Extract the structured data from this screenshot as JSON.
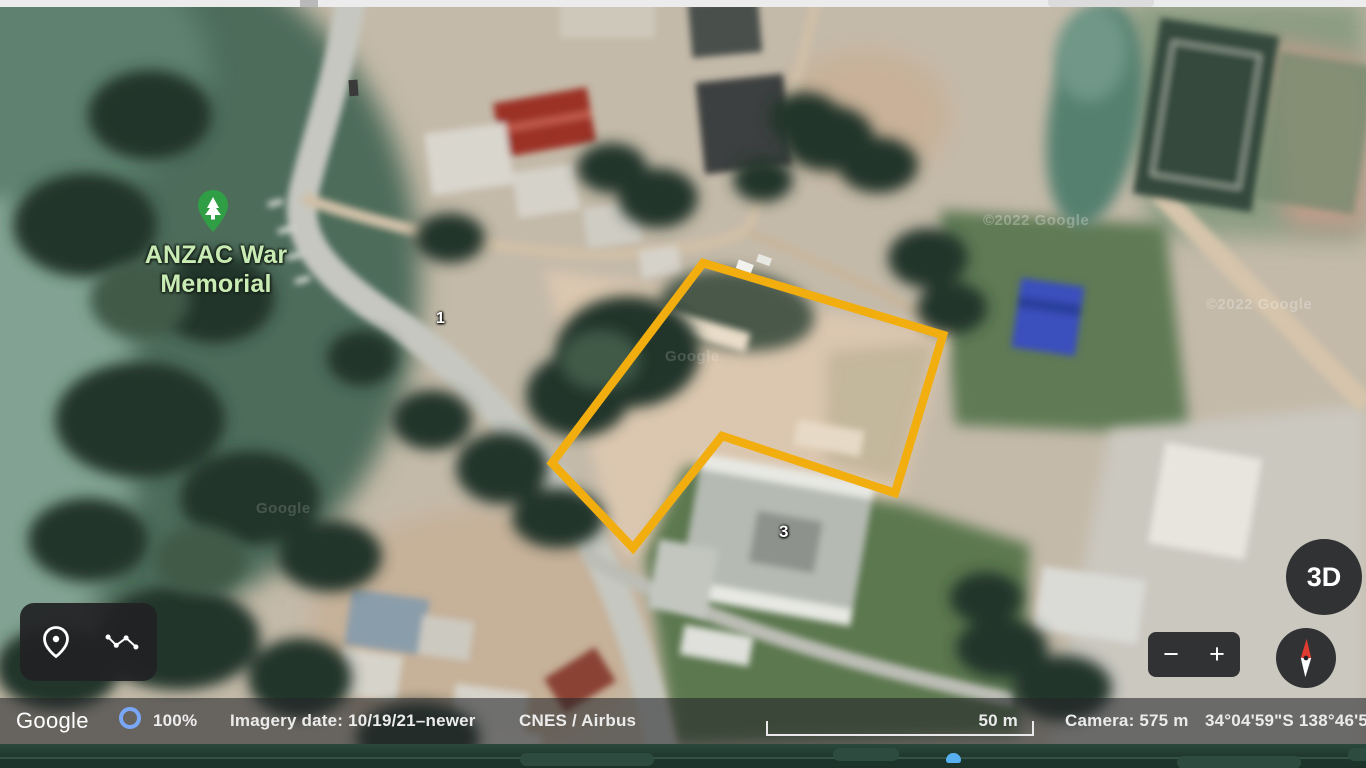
{
  "map": {
    "place_label": "ANZAC War Memorial",
    "marker_1": "1",
    "marker_3": "3",
    "watermark_a": "©2022 Google",
    "watermark_b": "©2022 Google",
    "watermark_c": "Google",
    "watermark_d": "Google"
  },
  "controls": {
    "three_d": "3D",
    "zoom_out": "−",
    "zoom_in": "+"
  },
  "status_bar": {
    "brand": "Google",
    "progress_percent": "100%",
    "imagery_date": "Imagery date: 10/19/21–newer",
    "provider": "CNES / Airbus",
    "scale_label": "50 m",
    "camera_altitude": "Camera: 575 m",
    "coordinates": "34°04'59\"S 138°46'5"
  },
  "colors": {
    "parcel_outline": "#F2AE0F",
    "placemark_green": "#2f9e44",
    "progress_ring_blue": "#7AA7F8",
    "compass_needle_red": "#E03B2F"
  }
}
